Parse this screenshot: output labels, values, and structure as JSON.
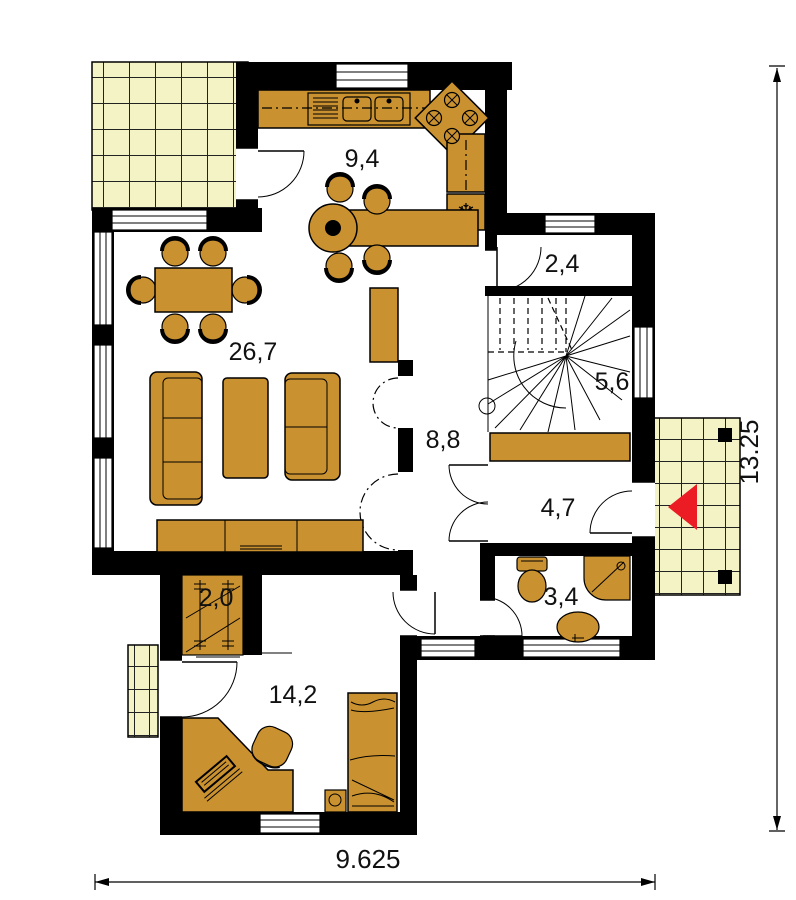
{
  "plan": {
    "title": "ground-floor-plan",
    "rooms": [
      {
        "name": "kitchen-dining",
        "area_label": "9,4"
      },
      {
        "name": "vestibule",
        "area_label": "2,4"
      },
      {
        "name": "living-room",
        "area_label": "26,7"
      },
      {
        "name": "staircase",
        "area_label": "5,6"
      },
      {
        "name": "hall",
        "area_label": "8,8"
      },
      {
        "name": "entry-hall",
        "area_label": "4,7"
      },
      {
        "name": "bathroom",
        "area_label": "3,4"
      },
      {
        "name": "wardrobe",
        "area_label": "2,0"
      },
      {
        "name": "bedroom",
        "area_label": "14,2"
      }
    ],
    "dimensions": {
      "total_width_m": "9.625",
      "total_height_m": "13.25"
    },
    "icons": {
      "fridge_snowflake": "❄",
      "entrance_arrow": "left-pointing-triangle"
    },
    "colors": {
      "wall": "#000000",
      "furniture": "#c9912f",
      "tile": "#f3f3c5",
      "arrow": "#ec1c24",
      "background": "#ffffff"
    }
  }
}
